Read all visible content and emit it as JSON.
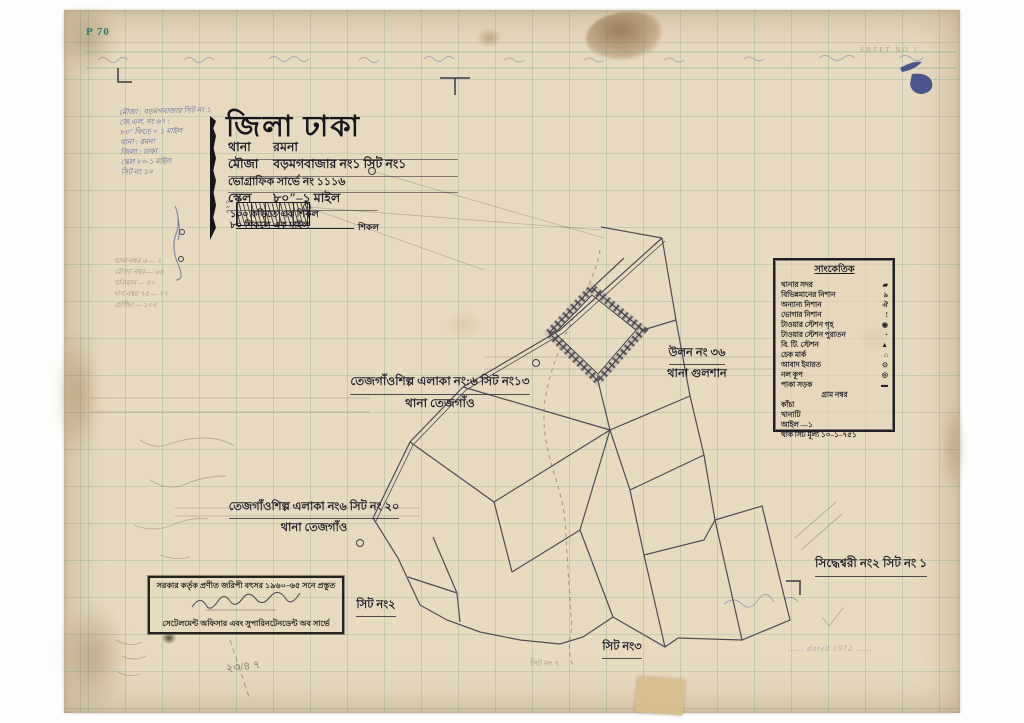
{
  "paper": {
    "corner_mark": "P 70",
    "sheet_note": "SHEET NO 1"
  },
  "title_block": {
    "district": "জিলা ঢাকা",
    "rows": [
      {
        "label": "থানা",
        "value": "রমনা"
      },
      {
        "label": "মৌজা",
        "value": "বড়মগবাজার নং১ সিট নং১"
      },
      {
        "label": "ভোগ্রাফিক সার্ভে নং",
        "value": "১১১৬"
      },
      {
        "label": "স্কেল",
        "value": "৮০″–১ মাইল"
      }
    ],
    "scale_notes": [
      "১০০ কড়িতে এক শিকল",
      "৮০ শিকলে এক মাইল"
    ],
    "scalebar_unit": "শিকল",
    "scalebar_numbers": "৪২০"
  },
  "handwritten_notes": [
    "মৌজা : বড়মগবাজার সিট নং ১",
    "জে.এল. নং ৬৭ :",
    "৮০″ ফিতে = ১ মাইল",
    "থানা : রমনা",
    "জিলা : ঢাকা",
    "স্কেল ৮০-১ মাইল",
    "সিট নং ১০"
  ],
  "pencil_notes": [
    "থানা নম্বর ৬ — ২",
    "মৌজা নম্বর — ৬৪",
    "খতিয়ান — ৪০",
    "দাগ নম্বর ৭৫ — ৭৭",
    "হোল্ডিং — ১০৪"
  ],
  "legend": {
    "title": "সাংকেতিক",
    "rows": [
      {
        "label": "থানার সদর",
        "symbol": "▰"
      },
      {
        "label": "বিভিন্নমানের নিশান",
        "symbol": "৯"
      },
      {
        "label": "অন্যান্য নিশান",
        "symbol": "ঐ"
      },
      {
        "label": "ভোগার নিশান",
        "symbol": "!"
      },
      {
        "label": "টাওয়ার স্টেশন গৃহ",
        "symbol": "◉"
      },
      {
        "label": "টাওয়ার স্টেশন পুরাতন",
        "symbol": "◔"
      },
      {
        "label": "বি. টি. স্টেশন",
        "symbol": "▲"
      },
      {
        "label": "চেক মার্ক",
        "symbol": "⌂"
      },
      {
        "label": "আবাদ ইমারত",
        "symbol": "⊙"
      },
      {
        "label": "নল কূপ",
        "symbol": "◎"
      },
      {
        "label": "পাকা সড়ক",
        "symbol": "▬"
      }
    ],
    "center_note": "গ্রাম নম্বর",
    "footer_rows": [
      "কাঁচা",
      "খানাটি",
      "আইল —১",
      "থাক সিট মূল্য ১০–১–৭৫১"
    ]
  },
  "map_labels": {
    "area_ne_line1": "তেজগাঁওশিল্প এলাকা নং:৬ সিট নং১৩",
    "area_ne_line2": "থানা তেজগাঁও",
    "area_w_line1": "তেজগাঁওশিল্প এলাকা নং৬ সিট নং ২০",
    "area_w_line2": "থানা তেজগাঁও",
    "gulshan_line1": "উলন নং ৩৬",
    "gulshan_line2": "থানা গুলশান",
    "siddheswari": "সিদ্ধেশ্বরী নং২ সিট নং ১",
    "sheet2": "সিট নং২",
    "sheet3": "সিট নং৩",
    "sheet7_faint": "সিট নং ৭"
  },
  "stamp_box": {
    "line1": "সরকার কর্তৃক প্রণীত জরিপী বৎসর ১৯৬০–৬৫ সনে প্রস্তুত",
    "line2": "সেটেলমেন্ট অফিসার এবং সুপারিনটেনডেন্ট অব সার্ভে"
  },
  "misc": {
    "bottom_left_scribble": "২৩/৪ ৭",
    "bottom_right_note": "……  dated 1972 ……"
  }
}
